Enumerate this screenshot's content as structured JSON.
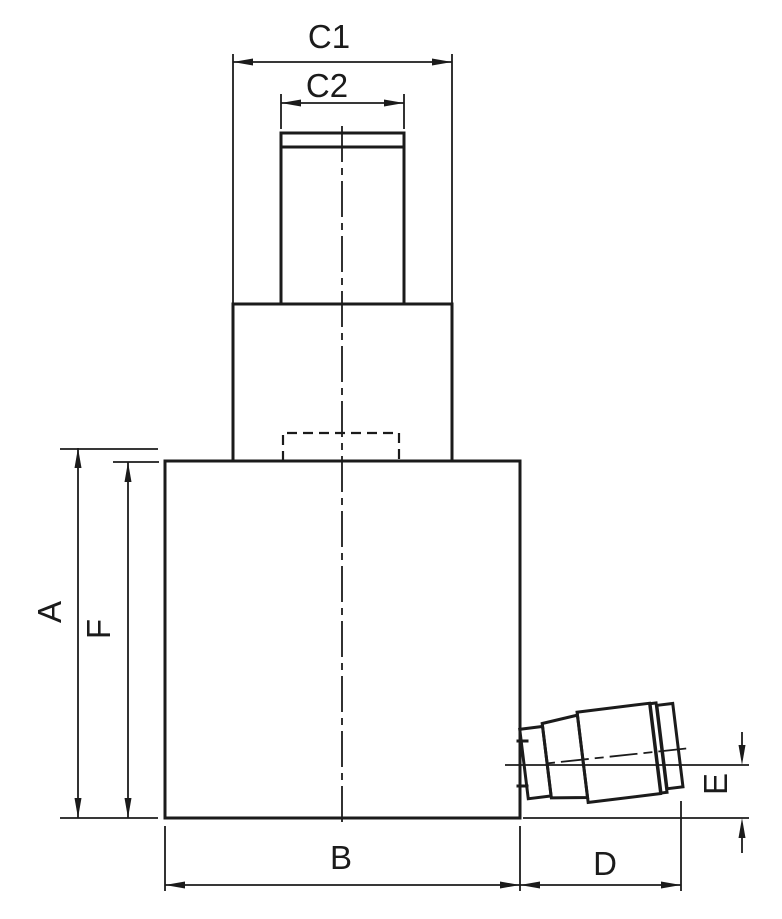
{
  "drawing": {
    "background_color": "#ffffff",
    "line_color": "#1b1b1b"
  },
  "labels": {
    "c1": "C1",
    "c2": "C2",
    "a": "A",
    "f": "F",
    "b": "B",
    "d": "D",
    "e": "E"
  }
}
